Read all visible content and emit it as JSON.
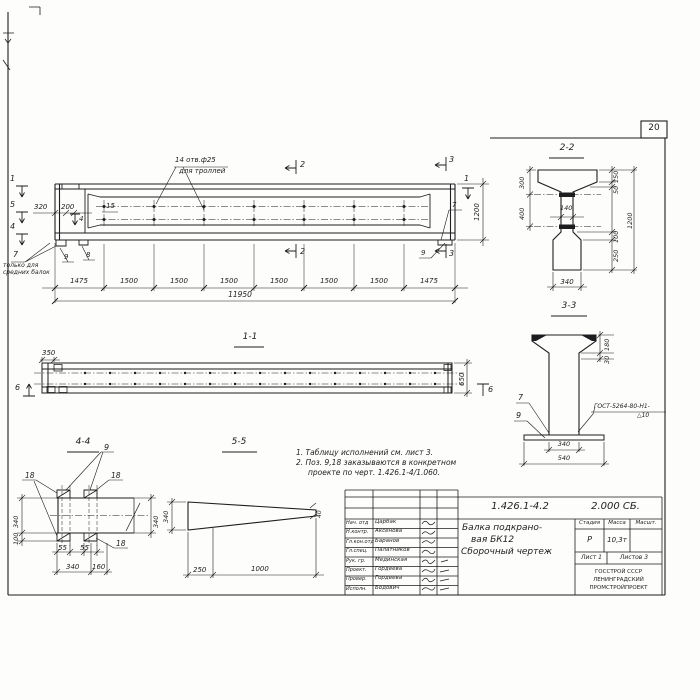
{
  "sheet": {
    "page_number": "20"
  },
  "main_view": {
    "holes_note": {
      "line1": "14 отв.ф25",
      "line2": "для троллей"
    },
    "markers": {
      "m1": "1",
      "m5": "5",
      "m4": "4",
      "m2": "2",
      "m3": "3"
    },
    "callouts": {
      "c7": "7",
      "c8": "8",
      "c9": "9",
      "c15": "15"
    },
    "note_middle_beams": {
      "line1": "только для",
      "line2": "средних балок"
    },
    "dims": {
      "d320": "320",
      "d200": "200",
      "chain": [
        "1475",
        "1500",
        "1500",
        "1500",
        "1500",
        "1500",
        "1500",
        "1475"
      ],
      "total": "11950",
      "height": "1200"
    }
  },
  "section22": {
    "title": "2-2",
    "d300": "300",
    "d400": "400",
    "d150": "150",
    "d50": "50",
    "d1200": "1200",
    "d100": "100",
    "d250": "250",
    "d140": "140",
    "d340": "340"
  },
  "section33": {
    "title": "3-3",
    "d180": "180",
    "d30": "30",
    "d340": "340",
    "d540": "540",
    "c7": "7",
    "c9": "9",
    "weld1": "ГОСТ-5264-80-Н1-",
    "weld2": "△10"
  },
  "section11": {
    "title": "1-1",
    "d350": "350",
    "d650": "650",
    "m6": "6"
  },
  "section44": {
    "title": "4-4",
    "c9": "9",
    "c18": "18",
    "d340l": "340",
    "d100": "100",
    "d340r": "340",
    "d55": "55",
    "d340b": "340",
    "d160": "160"
  },
  "section55": {
    "title": "5-5",
    "d340": "340",
    "d40": "40",
    "d250": "250",
    "d1000": "1000"
  },
  "notes": {
    "line1": "1. Таблицу исполнений см. лист 3.",
    "line2": "2. Поз. 9,18 заказываются в конкретном",
    "line3": "проекте по черт. 1.426.1-4/1.060."
  },
  "title_block": {
    "doc_number": "1.426.1-4.2",
    "doc_code": "2.000 СБ.",
    "title_line1": "Балка подкрано-",
    "title_line2": "вая БК12",
    "title_line3": "Сборочный чертеж",
    "col_stage": "Стадия",
    "col_mass": "Масса",
    "col_scale": "Масшт.",
    "stage": "Р",
    "mass": "10,3т",
    "sheet_label": "Лист 1",
    "sheets_label": "Листов 3",
    "org1": "ГОССТРОЙ СССР",
    "org2": "ЛЕНИНГРАДСКИЙ",
    "org3": "ПРОМСТРОЙПРОЕКТ",
    "signature_rows": [
      {
        "role": "Нач. отд",
        "name": "Царбак"
      },
      {
        "role": "Н.контр.",
        "name": "Аксенова"
      },
      {
        "role": "Гл.кон.отд",
        "name": "Баранов"
      },
      {
        "role": "Гл.спец.",
        "name": "Палатников"
      },
      {
        "role": "Рук. гр.",
        "name": "Мединская"
      },
      {
        "role": "Проект.",
        "name": "Гордеева"
      },
      {
        "role": "Провер.",
        "name": "Гордеева"
      },
      {
        "role": "Исполн.",
        "name": "Бодович"
      }
    ]
  },
  "colors": {
    "ink": "#1d1d1f",
    "paper": "#fdfdfb"
  }
}
